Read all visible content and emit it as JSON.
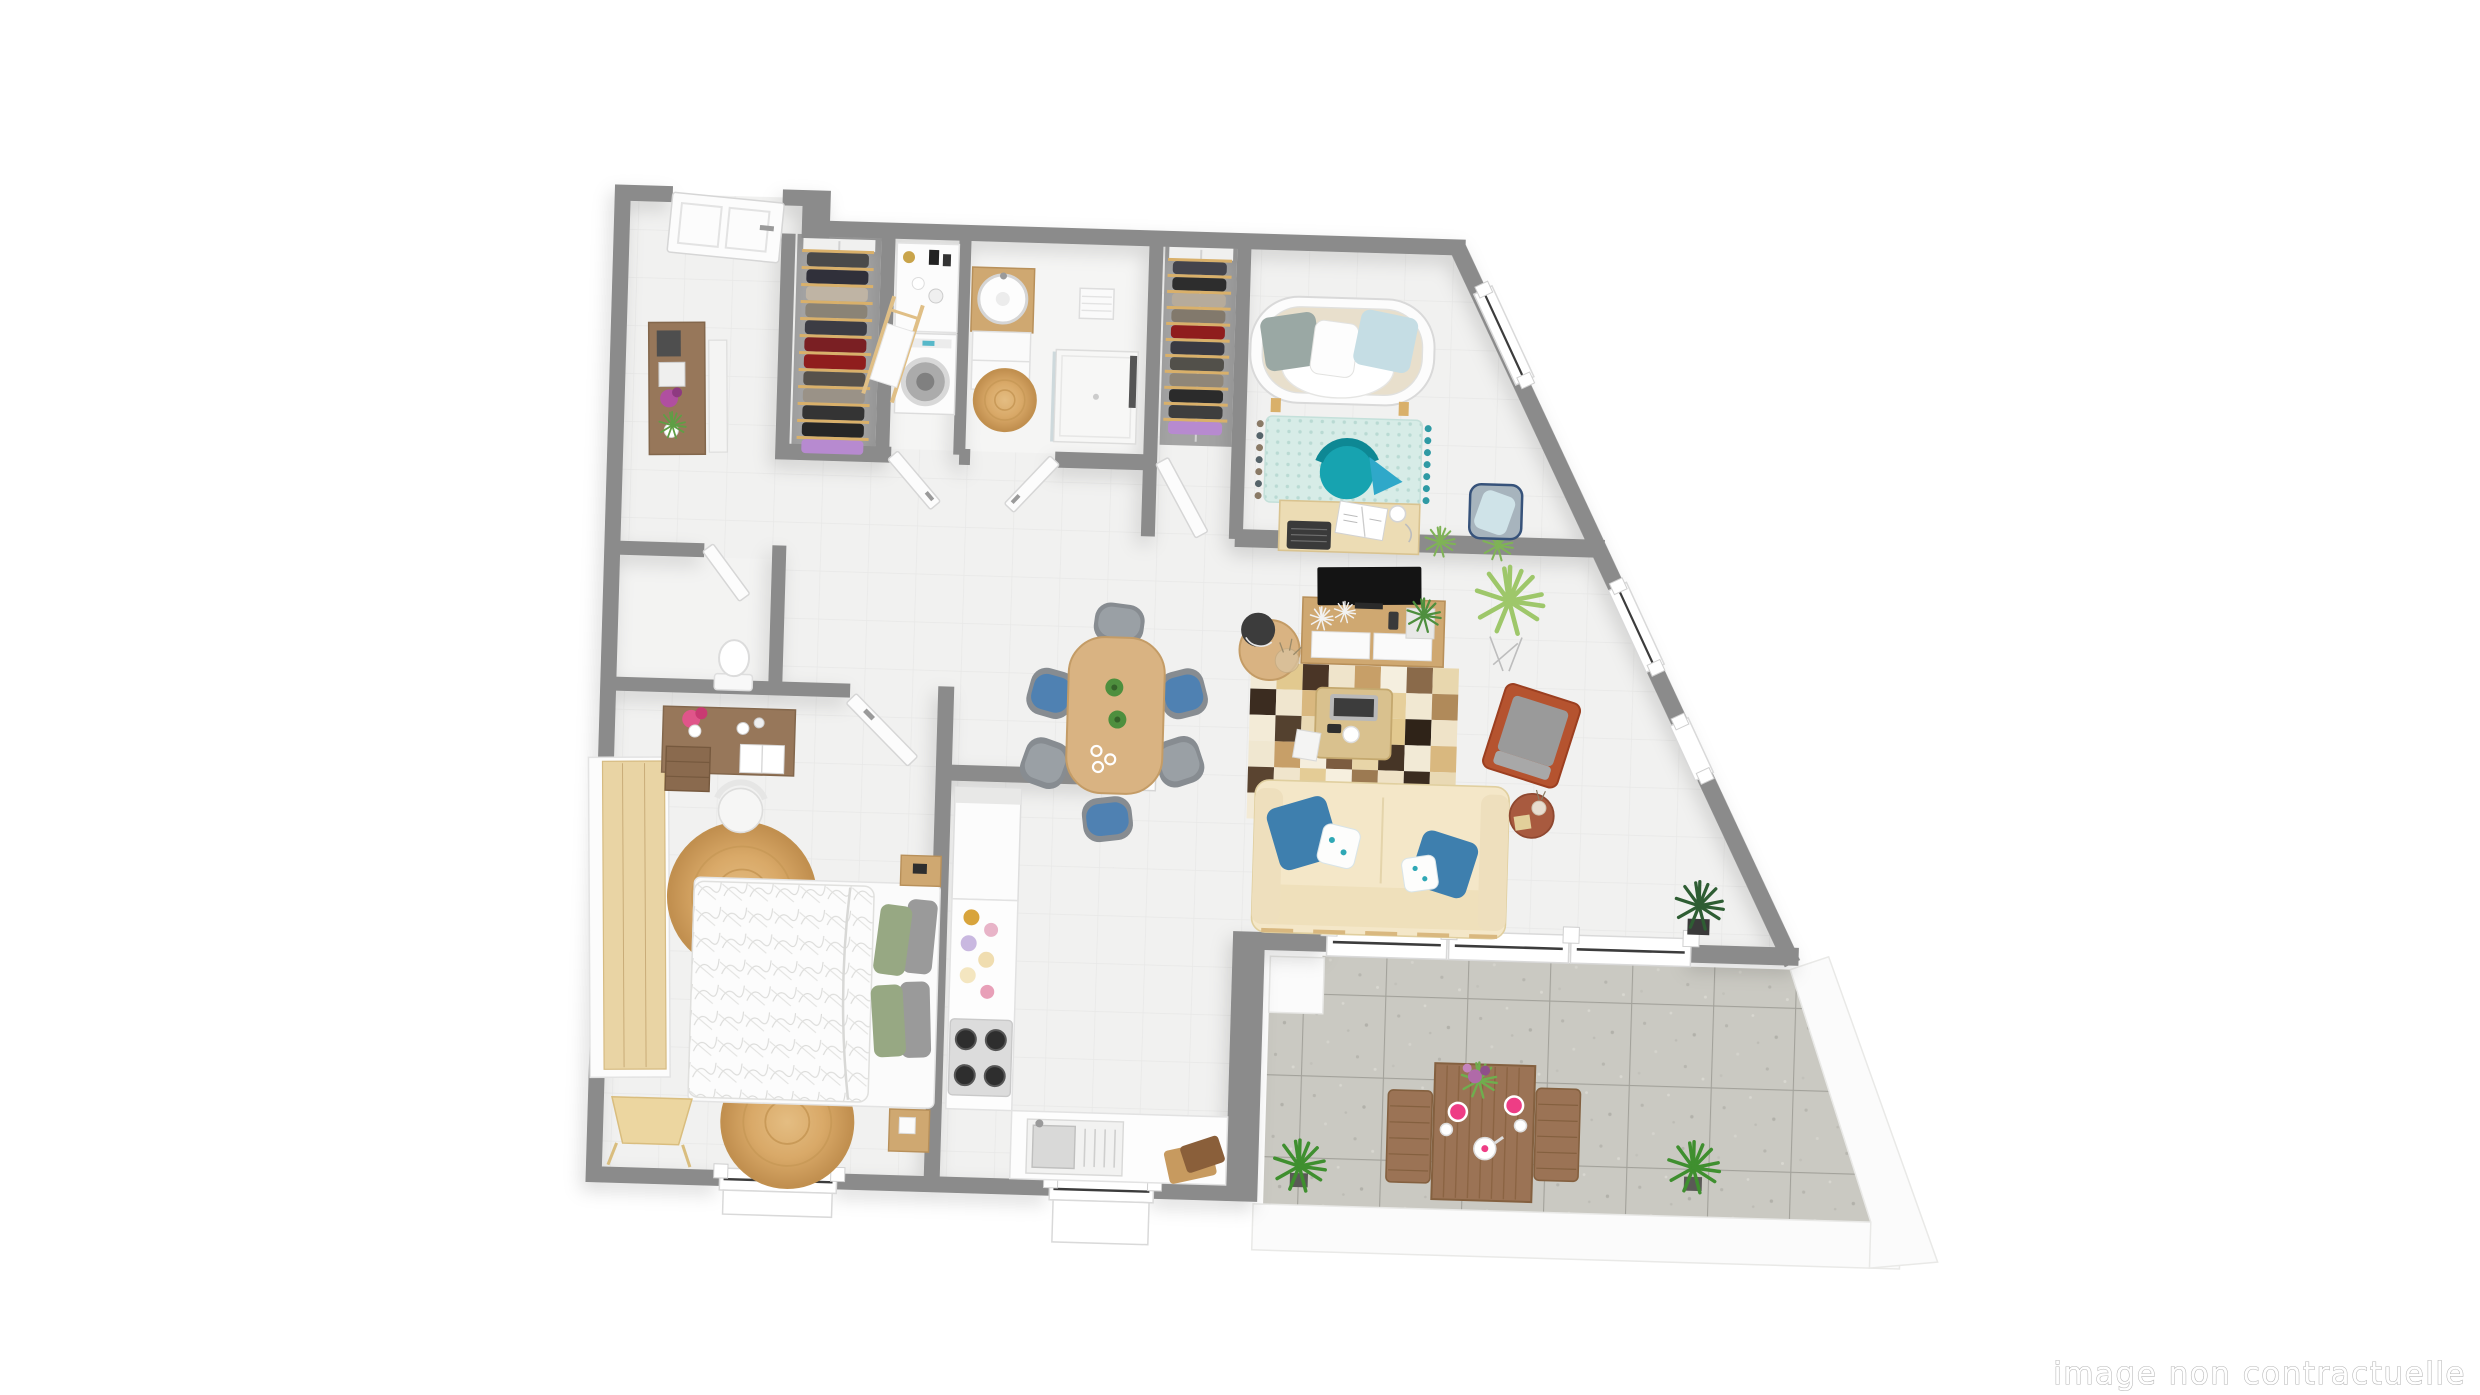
{
  "watermark": {
    "text": "image non contractuelle"
  },
  "palette": {
    "wall": "#8b8b8b",
    "floor": "#f1f1f0",
    "floor_line": "#e8e8e7",
    "bath_floor": "#f5f5f4",
    "closet_floor": "#a3a3a3",
    "terrace_tile": "#cac9c2",
    "terrace_joint": "#a3a29b",
    "white_unit": "#fcfcfc",
    "wood_light": "#e9d4a4",
    "wood_mid": "#cfa871",
    "wood_dark": "#97775a",
    "wood_table": "#d9b382",
    "sofa": "#f4e7c8",
    "sofa_frame": "#e2c48c",
    "pillow_blue": "#3e7fae",
    "pillow_light": "#c5dde4",
    "pillow_green": "#97a883",
    "pillow_gray": "#9a9a9a",
    "teal_chair": "#17a3b0",
    "mint_rug": "#d7ece7",
    "terracotta": "#b5532f",
    "side_table_clay": "#a85a3f",
    "gray_chair": "#878c91",
    "chair_blue": "#4f81b2",
    "jute": "#d9a968",
    "plant_green": "#5f9e45",
    "plant_dark": "#2e5d33",
    "plant_airy": "#9ec76a",
    "plate_pink": "#ee3d85",
    "terrace_wood": "#9b7355"
  },
  "living_room": {
    "patchwork_rug": {
      "x": 1250,
      "y": 655,
      "cols": 8,
      "rows": 6,
      "cell": 26,
      "colors": [
        "#f2ead6",
        "#e2c98f",
        "#4a3526",
        "#efe4cb",
        "#c79f68",
        "#f5efdf",
        "#8a6a4a",
        "#e8d7ae",
        "#3b2c20",
        "#f0e6cf",
        "#d9b87f",
        "#f4ecd9",
        "#6b4f38",
        "#e6cf9b",
        "#f1e8d2",
        "#b08a5a",
        "#f3ebd7",
        "#54412f",
        "#e9d9b4",
        "#f6f0e0",
        "#8a6a4a",
        "#e2c98f",
        "#2f2318",
        "#efe3c8",
        "#f0e7d0",
        "#c79f68",
        "#f5eedd",
        "#7c5c40",
        "#e8d5a8",
        "#463526",
        "#f2ead6",
        "#d9b87f",
        "#5a4430",
        "#f0e5cc",
        "#e4cc96",
        "#f6efde",
        "#9c7a52",
        "#efe2c6",
        "#3b2c20",
        "#e9d9b4",
        "#f3ead5",
        "#c0945e",
        "#f0e6cf",
        "#63503a",
        "#e6d0a0",
        "#f5eedd",
        "#8a6a4a",
        "#efe4cb"
      ]
    }
  },
  "closets": [
    {
      "id": 1,
      "x": 825,
      "y": 258,
      "w": 62,
      "step": 17,
      "garments": [
        "#4a4a4a",
        "#30303a",
        "#bfb4a4",
        "#8a8376",
        "#3c3c44",
        "#7a1f23",
        "#8f1d1d",
        "#56514b",
        "#9a9287",
        "#343434",
        "#262626",
        "#b78ad0"
      ]
    },
    {
      "id": 2,
      "x": 1187,
      "y": 256,
      "w": 54,
      "step": 16,
      "garments": [
        "#44444c",
        "#2d2d2d",
        "#b6ab9b",
        "#82796c",
        "#8f1d1d",
        "#3a3a42",
        "#52504a",
        "#8f8678",
        "#2b2b2b",
        "#3e3e3e",
        "#b78ad0"
      ]
    }
  ]
}
